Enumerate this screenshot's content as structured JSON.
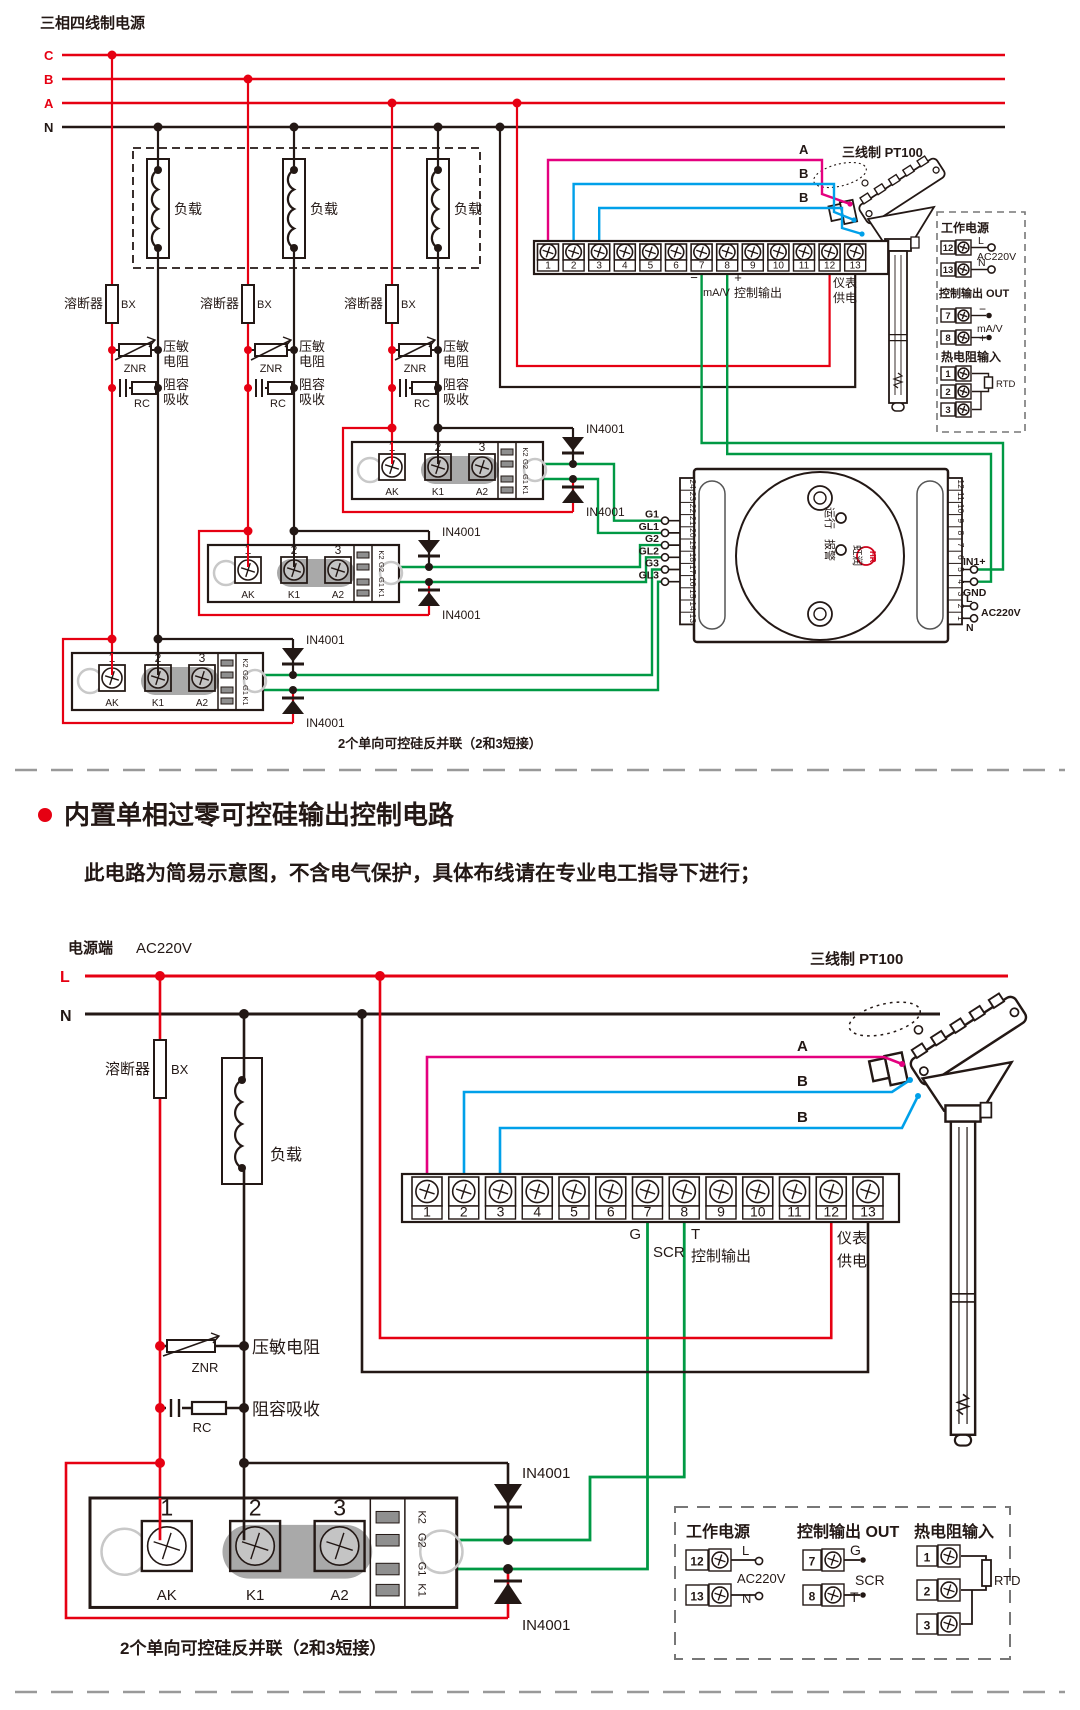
{
  "colors": {
    "red": "#e60012",
    "ink": "#231815",
    "green": "#009944",
    "magenta": "#e4007f",
    "blue": "#00a0e9",
    "gray": "#9a9a9a",
    "pale": "#c8c8c8",
    "bridge": "#a9a9a9",
    "brand": "#d0021b"
  },
  "shared": {
    "load": "负载",
    "fuse": "溶断器",
    "fuse_code": "BX",
    "znr": "ZNR",
    "rc": "RC",
    "diode": "IN4001",
    "ctrl_out": "控制输出",
    "meter": [
      "仪表",
      "供电"
    ],
    "pt100": "三线制 PT100",
    "caption": "2个单向可控硅反并联（2和3短接）",
    "block_nums": [
      "1",
      "2",
      "3",
      "4",
      "5",
      "6",
      "7",
      "8",
      "9",
      "10",
      "11",
      "12",
      "13"
    ],
    "module": {
      "nums": [
        "1",
        "2",
        "3"
      ],
      "names": [
        "AK",
        "K1",
        "A2"
      ],
      "side": [
        "K2",
        "G2",
        "G1",
        "K1"
      ]
    }
  },
  "top": {
    "title": "三相四线制电源",
    "phases": [
      "C",
      "B",
      "A",
      "N"
    ],
    "varistor": [
      "压敏",
      "电阻"
    ],
    "rc": [
      "阻容",
      "吸收"
    ],
    "gates": [
      "G1",
      "GL1",
      "G2",
      "GL2",
      "G3",
      "GL3"
    ],
    "tb": {
      "minus": "−",
      "mav": "mA/V",
      "plus": "+"
    },
    "wires": [
      "A",
      "B",
      "B"
    ],
    "controller": {
      "left": [
        "24",
        "23",
        "22",
        "21",
        "20",
        "19",
        "18",
        "17",
        "16",
        "15",
        "14",
        "13"
      ],
      "right": [
        "12",
        "11",
        "10",
        "9",
        "8",
        "7",
        "6",
        "5",
        "4",
        "3",
        "2",
        "1"
      ],
      "in1": "IN1+",
      "gnd": "GND",
      "l": "L",
      "ac": "AC220V",
      "n": "N",
      "run": "运行",
      "alarm": "报警",
      "brand": "虹润",
      "logo": "HR"
    }
  },
  "legend_top": {
    "power_title": "工作电源",
    "rows_power": [
      {
        "n": "12",
        "lab": "L"
      },
      {
        "n": "13",
        "lab": "N"
      }
    ],
    "ac": "AC220V",
    "out_title": "控制输出 OUT",
    "rows_out": [
      {
        "n": "7",
        "lab": "−"
      },
      {
        "n": "8",
        "lab": "+"
      }
    ],
    "out_mid": "mA/V",
    "rtd_title": "热电阻输入",
    "rtd_rows": [
      "1",
      "2",
      "3"
    ],
    "rtd_code": "RTD"
  },
  "section": {
    "title": "内置单相过零可控硅输出控制电路",
    "subtitle": "此电路为简易示意图，不含电气保护，具体布线请在专业电工指导下进行；"
  },
  "bottom": {
    "power": "电源端",
    "voltage": "AC220V",
    "lines": [
      "L",
      "N"
    ],
    "varistor": "压敏电阻",
    "rc_label": "阻容吸收",
    "tb": {
      "g": "G",
      "scr": "SCR",
      "t": "T"
    },
    "wires": [
      "A",
      "B",
      "B"
    ]
  },
  "legend_bottom": {
    "power_title": "工作电源",
    "rows_power": [
      {
        "n": "12",
        "lab": "L"
      },
      {
        "n": "13",
        "lab": "N"
      }
    ],
    "ac": "AC220V",
    "out_title": "控制输出 OUT",
    "rows_out": [
      {
        "n": "7",
        "lab": "G"
      },
      {
        "n": "8",
        "lab": "T"
      }
    ],
    "out_mid": "SCR",
    "rtd_title": "热电阻输入",
    "rtd_rows": [
      "1",
      "2",
      "3"
    ],
    "rtd_code": "RTD"
  }
}
